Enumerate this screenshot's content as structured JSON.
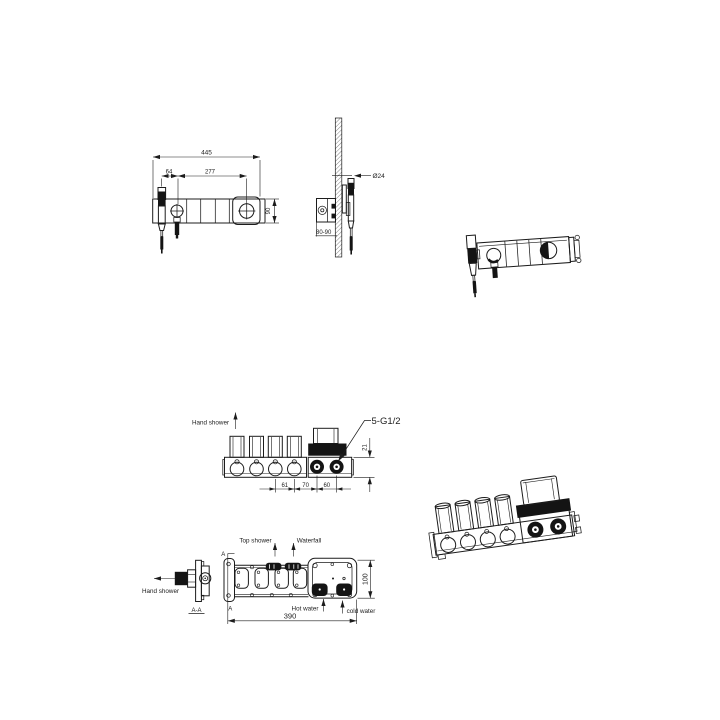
{
  "title": "Shower mixer valve technical drawing",
  "colors": {
    "ink": "#1c1c1c",
    "background": "#ffffff"
  },
  "views": {
    "trim_front": {
      "dims": {
        "overall_width": "445",
        "dial_spacing": "277",
        "shower_offset": "64",
        "plate_height": "90"
      }
    },
    "trim_side": {
      "dims": {
        "holder_diameter": "Ø24",
        "recess_depth": "80-90"
      }
    },
    "valve_front": {
      "labels": {
        "hand_shower": "Hand shower",
        "connections": "5-G1/2"
      },
      "dims": {
        "spacing_a": "61",
        "spacing_b": "70",
        "spacing_c": "60",
        "inlet_offset": "21"
      }
    },
    "valve_plan": {
      "labels": {
        "top_shower": "Top shower",
        "waterfall": "Waterfall",
        "hot_water": "Hot water",
        "cold_water": "cold water"
      },
      "dims": {
        "length": "390",
        "depth": "100"
      },
      "section_marker_top": "A",
      "section_marker_bottom": "A"
    },
    "valve_section": {
      "labels": {
        "hand_shower": "Hand shower"
      },
      "title": "A-A"
    }
  }
}
